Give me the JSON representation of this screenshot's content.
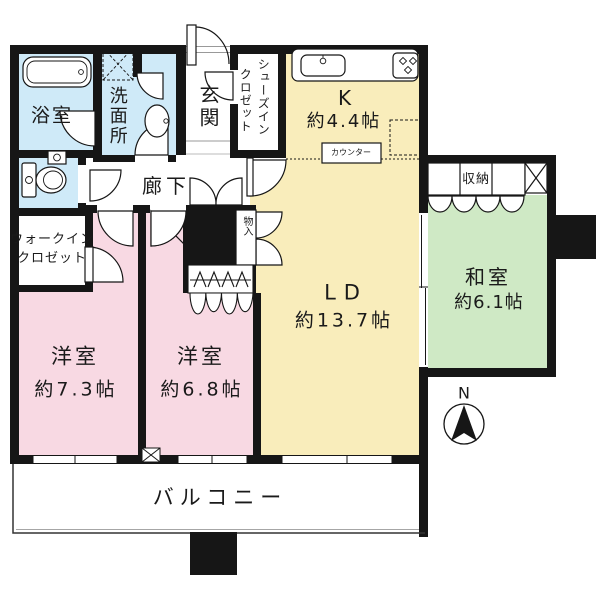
{
  "colors": {
    "wall": "#161616",
    "room_pink": "#f8d9e3",
    "room_blue": "#cfeaf8",
    "room_yellow": "#f9edbb",
    "room_green": "#cfe9c5"
  },
  "labels": {
    "bathroom": "浴室",
    "washroom": "洗面所",
    "entrance": "玄関",
    "shoe_closet_col1": "シューズイン",
    "shoe_closet_col2": "クロゼット",
    "kitchen_name": "K",
    "kitchen_size": "約4.4帖",
    "counter": "カウンター",
    "hallway": "廊下",
    "storage_small": "物入",
    "wic_line1": "ウォークイン",
    "wic_line2": "クロゼット",
    "bedroom1_name": "洋室",
    "bedroom1_size": "約7.3帖",
    "bedroom2_name": "洋室",
    "bedroom2_size": "約6.8帖",
    "living_name": "LD",
    "living_size": "約13.7帖",
    "japanese_name": "和室",
    "japanese_size": "約6.1帖",
    "storage": "収納",
    "balcony": "バルコニー",
    "compass_north": "N"
  }
}
